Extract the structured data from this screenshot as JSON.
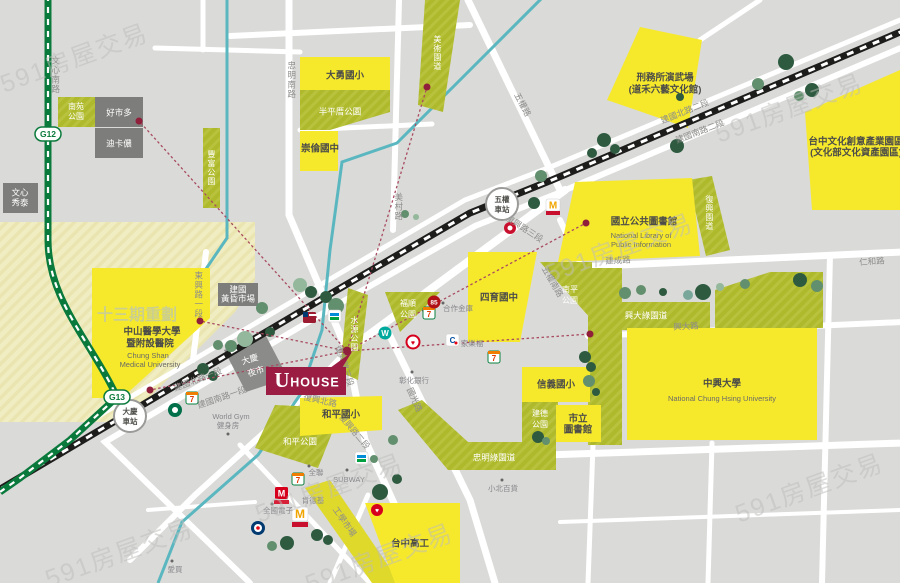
{
  "map": {
    "watermark": "591房屋交易",
    "project": {
      "logo_u": "U",
      "logo_house": "HOUSE"
    },
    "stations": {
      "g12": "G12",
      "g13": "G13",
      "wuquan": [
        "五權",
        "車站"
      ],
      "daqing": [
        "大慶",
        "車站"
      ]
    },
    "roads": {
      "wenxin_south": "文心南路",
      "zhongming_south": "忠明南路",
      "meicun": "美村路",
      "wuquan": "五權路",
      "fuxing_sec3_ne": "復興路三段",
      "fuxing_sec3_u": "復興路三段",
      "fuxing_sec2": "復興路二段",
      "fuxing_north": "復興北路",
      "jianguo_n1": "建國北路一段",
      "jianguo_s1": "建國南路一段",
      "jianguo_n2": "建國北路二段",
      "jianguo_s2": "建國南路二段",
      "dongxing_sec1": "東興路一段",
      "jiancheng": "建成路",
      "renhe": "仁和路",
      "xingda": "興大路",
      "wuquan_south": "五權南路",
      "guoguang": "國光路",
      "gongxue_market": "工學市場"
    },
    "parks": {
      "nanyuan": [
        "南苑",
        "公園"
      ],
      "fengfu": "豐富公園",
      "banpingcuo": "半平厝公園",
      "meishu_parkway": "美術園道",
      "fuxing_parkway": "復興園道",
      "nanping": [
        "南平",
        "公園"
      ],
      "xingda_greenway": "興大綠園道",
      "jiande": [
        "建德",
        "公園"
      ],
      "heping": "和平公園",
      "shuiyuan": "水源公園",
      "fushun": [
        "福順",
        "公園"
      ],
      "zhongming_greenway": "忠明綠園道"
    },
    "schools": {
      "dayong": "大勇國小",
      "chonglun": "崇倫國中",
      "siyu": "四育國中",
      "xinyi": "信義國小",
      "heping": "和平國小",
      "taichung_vocational": "台中高工",
      "chunghsing": "中興大學",
      "chunghsing_en": "National Chung Hsing University",
      "chungshan": [
        "中山醫學大學",
        "暨附設醫院",
        "Chung Shan",
        "Medical University"
      ]
    },
    "landmarks": {
      "library": "國立公共圖書館",
      "library_en": [
        "National Library of",
        "Public Information"
      ],
      "martial_arts_hall": [
        "刑務所演武場",
        "(道禾六藝文化館)"
      ],
      "cultural_park": [
        "台中文化創意產業園區",
        "(文化部文化資產園區)"
      ],
      "redevelopment": "十三期重劃",
      "city_library": [
        "市立",
        "圖書館"
      ]
    },
    "places": {
      "costco": "好市多",
      "decathlon": "迪卡儂",
      "showtime": [
        "文心",
        "秀泰"
      ],
      "evening_market": [
        "建國",
        "黃昏市場"
      ],
      "night_market": [
        "大慶",
        "夜市"
      ],
      "world_gym": "World Gym",
      "gym": "健身房",
      "subway": "SUBWAY",
      "pxmart": "全聯",
      "kfc": "肯德基",
      "quanguo": "全國電子",
      "aimai": "愛買",
      "xiaobei": "小北百貨",
      "changhua_bank": "彰化銀行",
      "hezuo_bank": "合作金庫",
      "carrefour": "家樂福"
    },
    "colors": {
      "yellow": "#f6e92c",
      "olive": "#aeb92c",
      "pale_zone": "#f1edc2",
      "rail": "#1d1d1b",
      "metro_green": "#0a7a3c",
      "canal": "#5ab7c0",
      "uhouse_red": "#9c1d44",
      "dotted_red": "#a84b60",
      "gray_box": "#7d7d7b"
    }
  }
}
